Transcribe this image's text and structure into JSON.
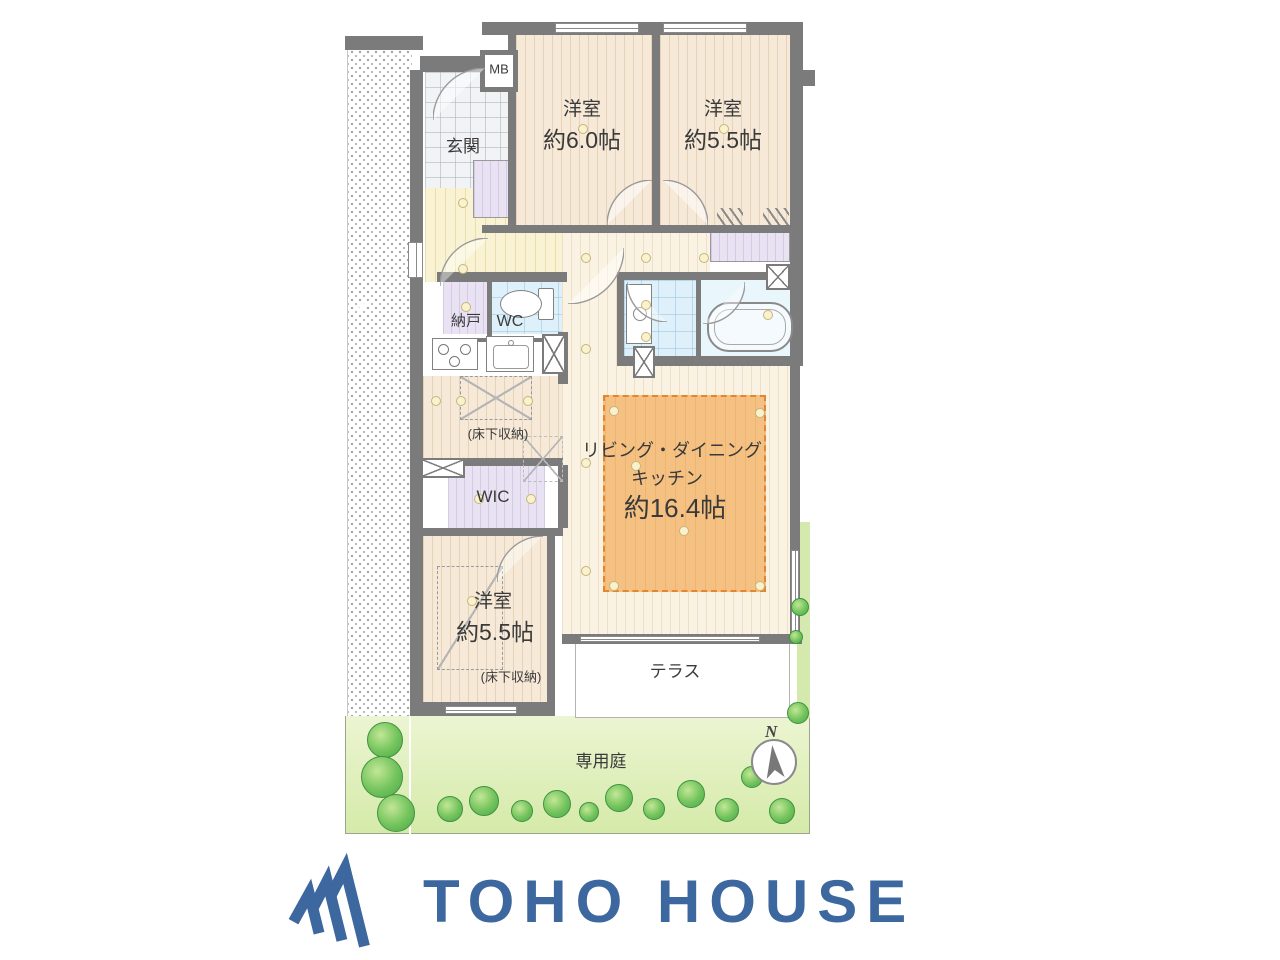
{
  "plan": {
    "meter_box": "MB",
    "entrance": "玄関",
    "bedroom_a": {
      "name": "洋室",
      "size": "約6.0帖"
    },
    "bedroom_b": {
      "name": "洋室",
      "size": "約5.5帖"
    },
    "storage": "納戸",
    "wc": "WC",
    "ldk": {
      "line1": "リビング・ダイニング",
      "line2": "キッチン",
      "size": "約16.4帖"
    },
    "wic": "WIC",
    "bedroom_c": {
      "name": "洋室",
      "size": "約5.5帖"
    },
    "underfloor_kitchen": "(床下収納)",
    "underfloor_bedroom": "(床下収納)",
    "terrace": "テラス",
    "garden": "専用庭",
    "compass_north": "N"
  },
  "logo": {
    "text": "TOHO HOUSE"
  },
  "colors": {
    "logo_blue": "#3c689f",
    "wall_gray": "#7b7b7b",
    "rug_orange": "#f5c183",
    "garden_green": "#d9ecb4",
    "wet_blue": "#dff0f9"
  }
}
